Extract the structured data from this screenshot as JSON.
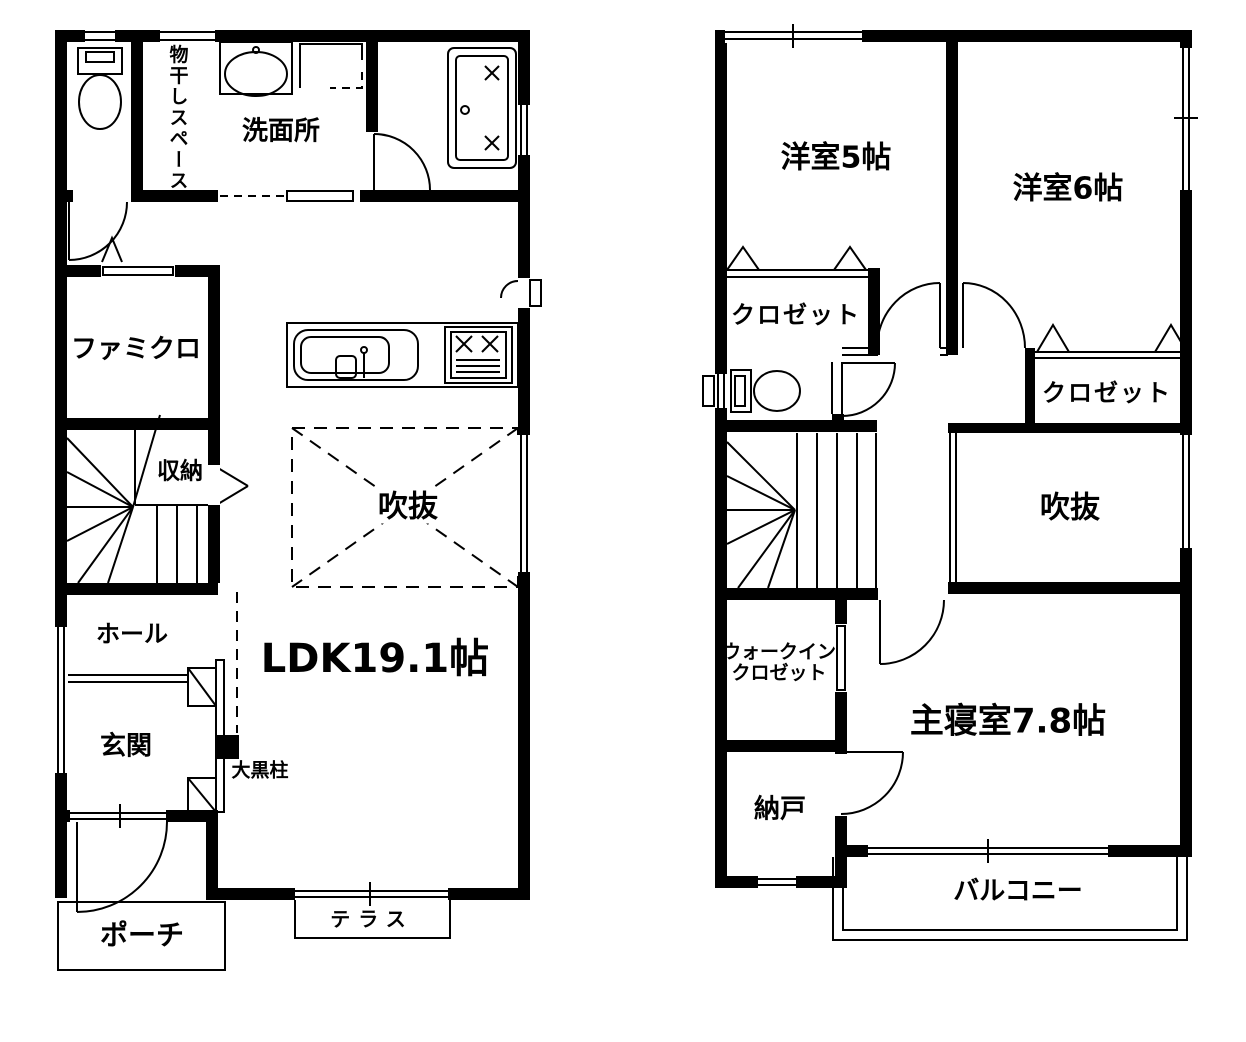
{
  "colors": {
    "wall": "#000000",
    "line": "#000000",
    "background": "#ffffff"
  },
  "floor1": {
    "labels": {
      "laundry_space": "物干しスペース",
      "washroom": "洗面所",
      "family_closet": "ファミクロ",
      "storage": "収納",
      "void": "吹抜",
      "hall": "ホール",
      "entrance": "玄関",
      "main_pillar": "大黒柱",
      "ldk": "LDK19.1帖",
      "porch": "ポーチ",
      "terrace": "テラス"
    }
  },
  "floor2": {
    "labels": {
      "western_room_5": "洋室5帖",
      "western_room_6": "洋室6帖",
      "closet_a": "クロゼット",
      "closet_b": "クロゼット",
      "void": "吹抜",
      "walk_in_closet_line1": "ウォークイン",
      "walk_in_closet_line2": "クロゼット",
      "master_bedroom": "主寝室7.8帖",
      "storeroom": "納戸",
      "balcony": "バルコニー"
    }
  }
}
